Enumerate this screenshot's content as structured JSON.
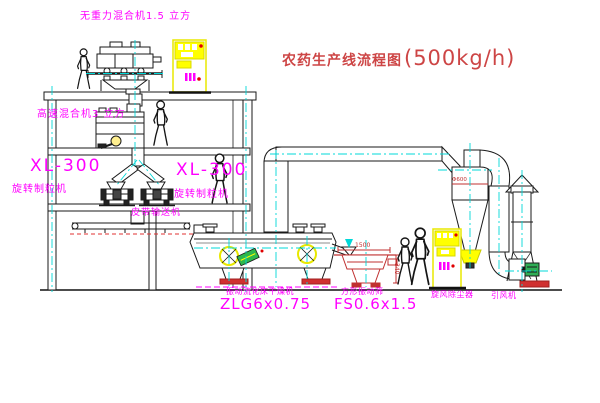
{
  "title": {
    "main": "农药生产线流程图",
    "capacity": "(500kg/h)"
  },
  "equipment_labels": {
    "gravity_free_mixer": "无重力混合机1.5 立方",
    "high_speed_mixer": "高速混合机3 立方",
    "granulator_left_model": "XL-300",
    "granulator_left_name": "旋转制粒机",
    "granulator_right_model": "XL-300",
    "granulator_right_name": "旋转制粒机",
    "belt_conveyor": "皮带输送机",
    "fluid_bed_dryer_name": "振动流化床干燥机",
    "fluid_bed_dryer_model": "ZLG6x0.75",
    "vibrating_screen_name": "方形振动筛",
    "vibrating_screen_model": "FS0.6x1.5",
    "cyclone_collector": "旋风除尘器",
    "induced_draft_fan": "引风机"
  },
  "dimensions": {
    "screen_length": "1500",
    "screen_height": "340",
    "cyclone_diameter": "Φ600"
  },
  "colors": {
    "label_magenta": "#ff00ff",
    "title_red": "#cd4545",
    "centerline_cyan": "#00d8d8",
    "cabinet_yellow": "#ffff00",
    "machine_red": "#c03030",
    "motor_green": "#2fae55"
  }
}
